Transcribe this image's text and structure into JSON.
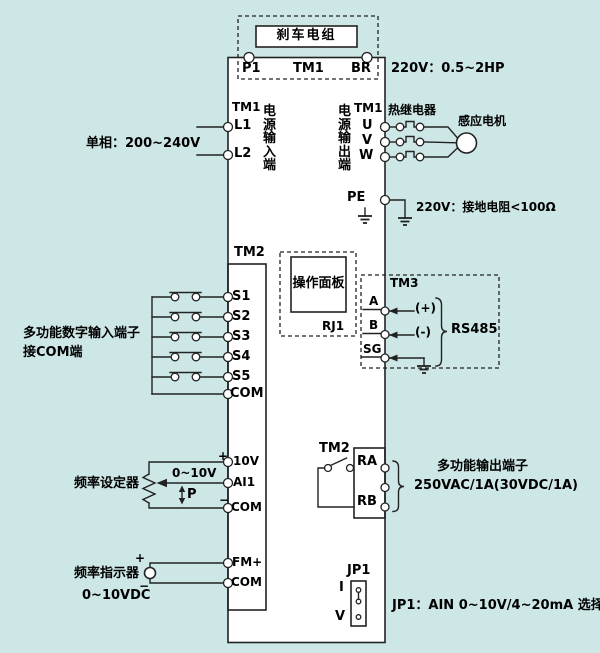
{
  "colors": {
    "background": "#cde7e6",
    "line": "#222222",
    "text": "#000000"
  },
  "top": {
    "brake_unit": "刹车电组",
    "p1": "P1",
    "tm1": "TM1",
    "br": "BR",
    "rating": "220V：0.5~2HP"
  },
  "input": {
    "tm1": "TM1",
    "l1": "L1",
    "l2": "L2",
    "phase": "单相：200~240V",
    "vlabel": "电源输入端"
  },
  "output": {
    "vlabel": "电源输出端",
    "tm1": "TM1",
    "u": "U",
    "v": "V",
    "w": "W",
    "relay": "热继电器",
    "motor": "感应电机"
  },
  "ground": {
    "pe": "PE",
    "note": "220V：接地电阻<100Ω"
  },
  "digital": {
    "tm2": "TM2",
    "terminals": [
      "S1",
      "S2",
      "S3",
      "S4",
      "S5",
      "COM"
    ],
    "note1": "多功能数字输入端子",
    "note2": "接COM端"
  },
  "panel": {
    "name": "操作面板",
    "port": "RJ1"
  },
  "rs485": {
    "tm3": "TM3",
    "a": "A",
    "b": "B",
    "sg": "SG",
    "plus": "(+)",
    "minus": "(-)",
    "name": "RS485"
  },
  "analog_in": {
    "plus": "+",
    "minus": "−",
    "v10": "10V",
    "ai1": "AI1",
    "com": "COM",
    "range": "0~10V",
    "p": "P",
    "label": "频率设定器"
  },
  "relay_out": {
    "tm2": "TM2",
    "ra": "RA",
    "rb": "RB",
    "note1": "多功能输出端子",
    "note2": "250VAC/1A(30VDC/1A)"
  },
  "analog_out": {
    "plus": "+",
    "minus": "−",
    "fm": "FM+",
    "com": "COM",
    "label": "频率指示器",
    "range": "0~10VDC"
  },
  "jumper": {
    "jp1": "JP1",
    "i": "I",
    "v": "V",
    "note": "JP1：AIN 0~10V/4~20mA 选择"
  }
}
